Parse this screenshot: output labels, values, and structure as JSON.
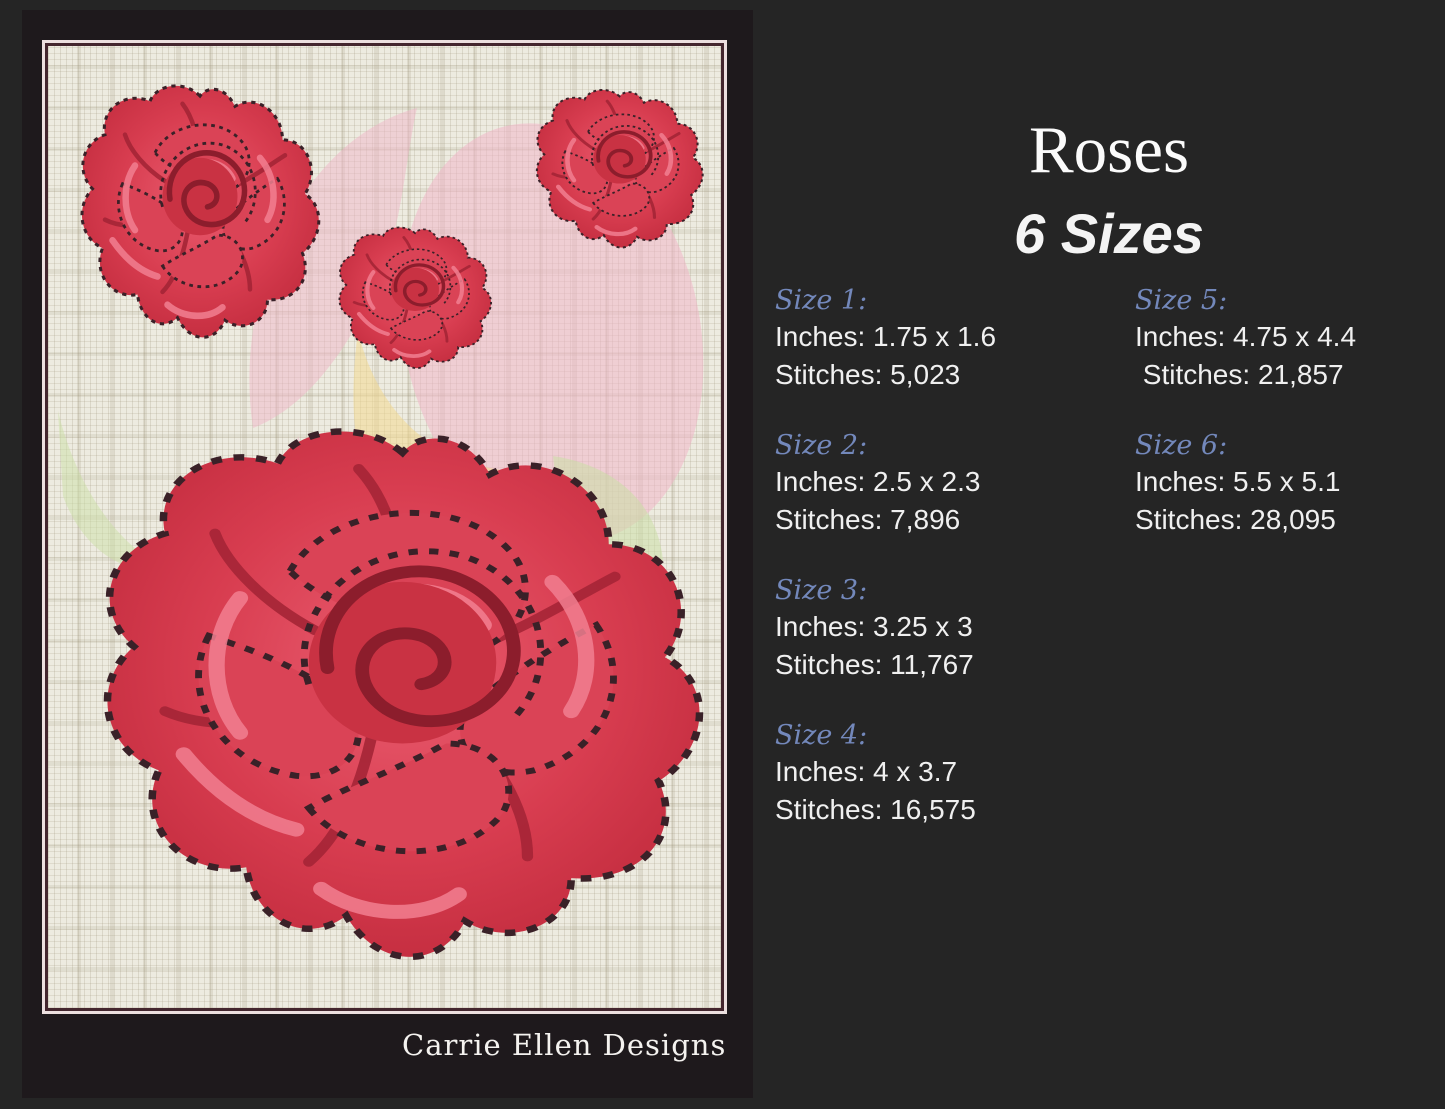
{
  "title": "Roses",
  "subtitle": "6 Sizes",
  "brand": "Carrie Ellen Designs",
  "sizes": [
    {
      "label": "Size 1:",
      "inches": "Inches: 1.75 x 1.6",
      "stitches": "Stitches: 5,023"
    },
    {
      "label": "Size 2:",
      "inches": "Inches: 2.5 x 2.3",
      "stitches": "Stitches: 7,896"
    },
    {
      "label": "Size 3:",
      "inches": "Inches: 3.25 x 3",
      "stitches": "Stitches: 11,767"
    },
    {
      "label": "Size 4:",
      "inches": "Inches: 4 x 3.7",
      "stitches": "Stitches: 16,575"
    },
    {
      "label": "Size 5:",
      "inches": "Inches: 4.75 x 4.4",
      "stitches": " Stitches: 21,857"
    },
    {
      "label": "Size 6:",
      "inches": "Inches: 5.5 x 5.1",
      "stitches": "Stitches: 28,095"
    }
  ],
  "colors": {
    "page_background": "#252525",
    "panel_background": "#1e191c",
    "fabric": "#edebe0",
    "frame_dark_border": "#44262e",
    "frame_light_border": "#ecdfdf",
    "size_label_accent": "#7388bb",
    "body_text": "#f0f0f0",
    "rose_red": "#d93c50",
    "rose_highlight": "#f2758a",
    "stitch_outline": "#3a2128",
    "watermark_pink": "#f0b6c8",
    "watermark_yellow": "#f3d88f",
    "watermark_green": "#cbdfa6"
  }
}
